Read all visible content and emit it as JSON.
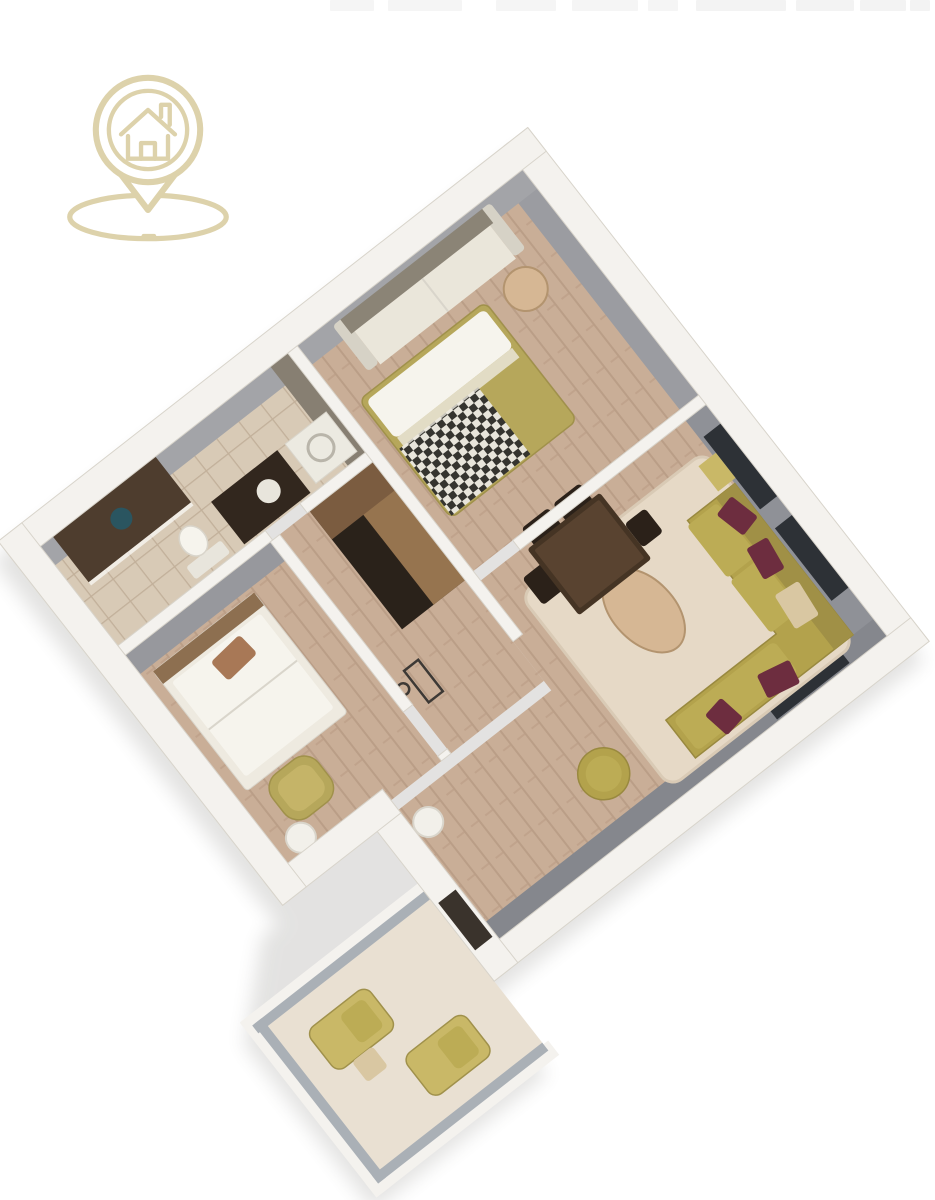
{
  "page": {
    "title": "3D apartment floor plan render",
    "top_artifact": "illegible cropped text strip"
  },
  "logo": {
    "name": "house-location-pin-logo",
    "title": "House location pin logo",
    "color": "#ddd2ab"
  },
  "floor_plan": {
    "title": "3D isometric apartment floor plan",
    "rotation_deg": 52,
    "rooms": [
      {
        "id": "bedroom-1",
        "floor": "wood",
        "furniture": [
          "gray-sofa",
          "olive-daybed",
          "checkered-throw",
          "round-side-table"
        ]
      },
      {
        "id": "living-room",
        "floor": "wood",
        "furniture": [
          "olive-corner-sofa",
          "maroon-pillows",
          "oval-coffee-table",
          "beige-rug",
          "pouf",
          "dining-table",
          "dining-chairs",
          "side-table"
        ]
      },
      {
        "id": "kitchen",
        "floor": "wood",
        "furniture": [
          "l-shaped-dark-cabinets"
        ]
      },
      {
        "id": "bathroom",
        "floor": "tile",
        "furniture": [
          "shower",
          "drain",
          "washer",
          "vanity",
          "toilet"
        ]
      },
      {
        "id": "bedroom-2",
        "floor": "wood",
        "furniture": [
          "single-bed",
          "brown-pillow",
          "olive-armchair",
          "round-white-table"
        ]
      },
      {
        "id": "hallway",
        "floor": "wood",
        "furniture": [
          "console-outline-symbol",
          "white-round-stool"
        ]
      },
      {
        "id": "balcony",
        "floor": "concrete",
        "furniture": [
          "lounge-chair",
          "lounge-chair",
          "small-table"
        ]
      }
    ],
    "palette": {
      "wall": "#f4f2ee",
      "wallline": "#d8d4cb",
      "face": "#8f9197",
      "faceL": "#a3a4a8",
      "faceA": "#9b9ca1",
      "faceR": "#85878d",
      "faceBath": "#877f72",
      "faceBed2": "#97989d",
      "win": "#2d3136",
      "wood": "#c9ae97",
      "woodline": "#b79a83",
      "tile": "#d8cab6",
      "tileline": "#c2b09a",
      "rug": "#e6d9c6",
      "rugline": "#d9cab5",
      "olive": "#b3a24c",
      "oliveSeat": "#bcac55",
      "oliveBack": "#a09046",
      "oliveEdge": "#99893f",
      "olive2": "#b6a75b",
      "olive2edge": "#a0914b",
      "oliveInner": "#c5b468",
      "oliveL": "#c9b867",
      "maroon": "#6d2d3f",
      "throw": "#d9c7a2",
      "tblwood": "#d6b794",
      "tbledge": "#b3946f",
      "dining": "#453424",
      "diningtop": "#594330",
      "chair": "#2b2119",
      "cabtop": "#96744f",
      "cabtop2": "#7b5c40",
      "cabdark": "#2a221a",
      "balc": "#e9e0d2",
      "rail": "#aab0b6",
      "sofaback": "#8b8476",
      "sofaseat": "#eae6da",
      "sofaarm": "#d6d2c6",
      "bedframe": "#eeeae0",
      "headboard": "#8d6f50",
      "mattress": "#f6f4ed",
      "pillowbrown": "#a87856",
      "white": "#f2f0ea",
      "whiteline": "#d9d5cb",
      "shower": "#4e3d2e",
      "drain": "#2a5560",
      "vanity": "#32271e",
      "sink": "#e8e5dc",
      "washer": "#eceae1",
      "drum": "#b9b5aa",
      "doordark": "#3a332c",
      "logo": "#ddd2ab",
      "checkA": "#35342f",
      "checkB": "#e8e5db",
      "shadow": "#55524c"
    }
  }
}
